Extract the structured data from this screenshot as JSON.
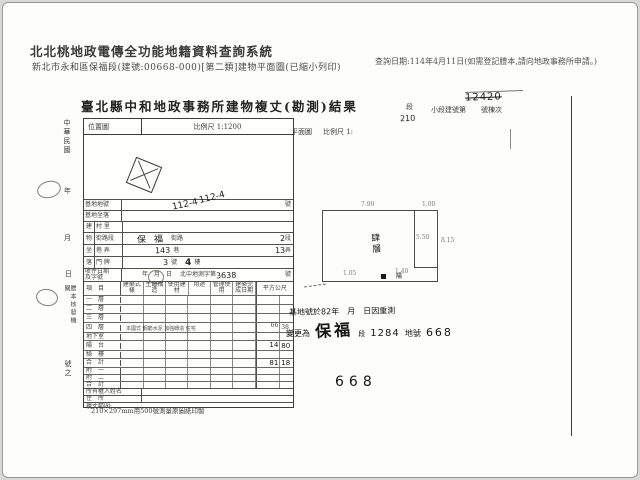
{
  "header": {
    "title": "北北桃地政電傳全功能地籍資料查詢系統",
    "subtitle": "新北市永和區保福段(建號:00668-000)[第二類]建物平面圖(已縮小列印)",
    "query_note": "查詢日期:114年4月11日(如需登記謄本,請向地政事務所申請。)"
  },
  "form": {
    "title": "臺北縣中和地政事務所建物複丈(勘測)結果",
    "top_fields": {
      "city_suffix": "市",
      "section_suffix": "段",
      "subsection_label": "小段建號第",
      "building_suffix": "號棟次",
      "crossed_out_number": "12420"
    },
    "left_margin": {
      "era": "中華民國",
      "year": "年",
      "month": "月",
      "day": "日",
      "issuer": "謄本核發機關",
      "number_suffix": "號之"
    },
    "location_map": {
      "label": "位置圖",
      "scale": "比例尺 1:1200",
      "lot_number_hw": "112-4"
    },
    "plan": {
      "label": "平面圖",
      "scale_label": "比例尺 1:",
      "scale_value_hw": "210",
      "floor_hw": "肆層",
      "dim_top": "7.90",
      "dim_top_right": "1.00",
      "dim_right": "8.15",
      "dim_inner": "5.50",
      "dim_bottom": "1.40",
      "dim_bottom_left": "1.05",
      "mark": "陽"
    },
    "site_rows": {
      "lot_label": "基地地號",
      "lot_value_hw": "112-4",
      "lot_suffix": "號",
      "site_label": "基地坐落",
      "group_chars": [
        "建",
        "物",
        "坐",
        "落"
      ],
      "village_label": "村 里",
      "street_label": "街路段",
      "street_value_hw": "保福",
      "street_mid": "街路",
      "street_sec_hw": "2",
      "street_suffix": "段",
      "lane_label": "巷 弄",
      "lane_value_hw": "143",
      "lane_mid": "巷",
      "alley_value_hw": "13",
      "lane_suffix": "弄",
      "door_label": "門 牌",
      "door_value_hw": "3",
      "door_mid": "號",
      "floor_value_hw": "4",
      "door_suffix": "樓",
      "receipt_label1": "收件日期",
      "receipt_label2": "及字號",
      "receipt_date": "年　月　日",
      "receipt_doc": "北中地測字第",
      "receipt_no_hw": "3638",
      "receipt_suffix": "號"
    },
    "floor_table": {
      "item_header": "項　目",
      "col_headers": [
        "建築式樣",
        "主體構造",
        "使用建材",
        "用途",
        "管理使用",
        "建築完成日期"
      ],
      "area_header": "平方公尺",
      "rows": [
        {
          "label": "一　層",
          "note": "",
          "area_int": "",
          "area_dec": ""
        },
        {
          "label": "二　層",
          "note": "",
          "area_int": "",
          "area_dec": ""
        },
        {
          "label": "三　層",
          "note": "",
          "area_int": "",
          "area_dec": ""
        },
        {
          "label": "四　層",
          "note": "本國式 鋼筋水泥 加強磚造 住宅",
          "area_int": "66",
          "area_dec": "38"
        },
        {
          "label": "地下室",
          "note": "",
          "area_int": "",
          "area_dec": ""
        },
        {
          "label": "陽　台",
          "note": "",
          "area_int": "14",
          "area_dec": "80"
        },
        {
          "label": "騎　樓",
          "note": "",
          "area_int": "",
          "area_dec": ""
        },
        {
          "label": "合　計",
          "note": "",
          "area_int": "81",
          "area_dec": "18"
        },
        {
          "label": "附　一",
          "note": "",
          "area_int": "",
          "area_dec": ""
        },
        {
          "label": "附　二",
          "note": "",
          "area_int": "",
          "area_dec": ""
        },
        {
          "label": "合　計",
          "note": "",
          "area_int": "",
          "area_dec": ""
        }
      ],
      "owner_label": "所有權人姓名",
      "address_label": "住　所",
      "scope_label": "複丈範圍:"
    },
    "annotation": {
      "line1": "基地號於82年　月　日因重測",
      "line2_prefix": "變更為",
      "section_hw": "保福",
      "section_suffix": "段",
      "lot_hw": "1284",
      "lot_label": "地號",
      "building_no_hw": "668"
    },
    "big_number": "668",
    "footer_note": "210×297mm用500號測量原圖紙印製"
  }
}
